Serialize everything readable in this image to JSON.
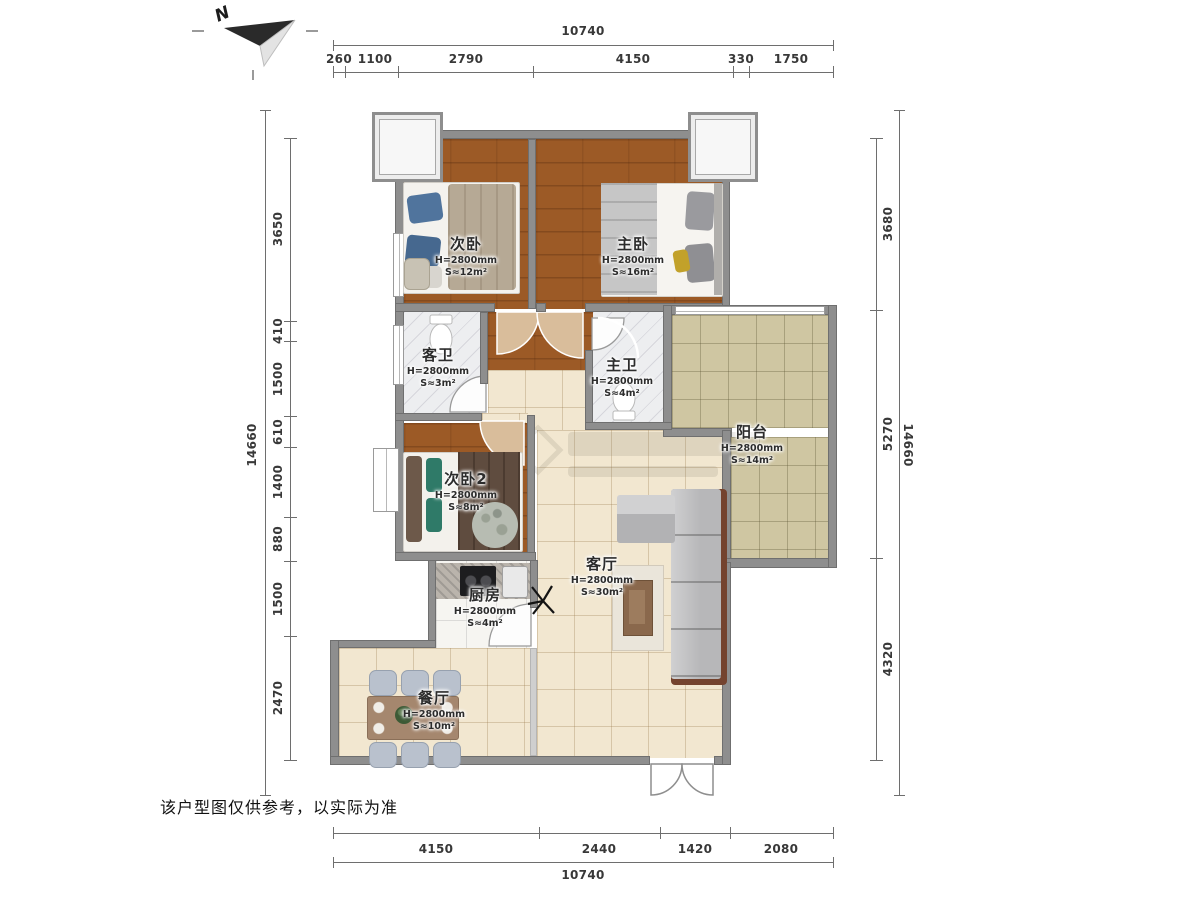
{
  "compass": {
    "label": "N"
  },
  "disclaimer": "该户型图仅供参考，以实际为准",
  "dims": {
    "top": {
      "total": "10740",
      "segments": [
        "260",
        "1100",
        "2790",
        "4150",
        "330",
        "1750"
      ]
    },
    "bottom": {
      "total": "10740",
      "segments": [
        "4150",
        "2440",
        "1420",
        "2080"
      ]
    },
    "left": {
      "total": "14660",
      "segments": [
        "3650",
        "410",
        "1500",
        "610",
        "1400",
        "880",
        "1500",
        "2470"
      ]
    },
    "right": {
      "total": "14660",
      "segments": [
        "3680",
        "5270",
        "4320"
      ]
    }
  },
  "rooms": [
    {
      "name": "次卧",
      "height": "H=2800mm",
      "area": "S≈12m²"
    },
    {
      "name": "主卧",
      "height": "H=2800mm",
      "area": "S≈16m²"
    },
    {
      "name": "客卫",
      "height": "H=2800mm",
      "area": "S≈3m²"
    },
    {
      "name": "主卫",
      "height": "H=2800mm",
      "area": "S≈4m²"
    },
    {
      "name": "阳台",
      "height": "H=2800mm",
      "area": "S≈14m²"
    },
    {
      "name": "次卧2",
      "height": "H=2800mm",
      "area": "S≈8m²"
    },
    {
      "name": "客厅",
      "height": "H=2800mm",
      "area": "S≈30m²"
    },
    {
      "name": "厨房",
      "height": "H=2800mm",
      "area": "S≈4m²"
    },
    {
      "name": "餐厅",
      "height": "H=2800mm",
      "area": "S≈10m²"
    }
  ],
  "colors": {
    "wood_floor": "#9c5a26",
    "living_tile": "#f2e7d0",
    "balcony_tile": "#cfc6a2",
    "wall": "#8e8e8e",
    "door_swing": "#d9bd9b"
  }
}
